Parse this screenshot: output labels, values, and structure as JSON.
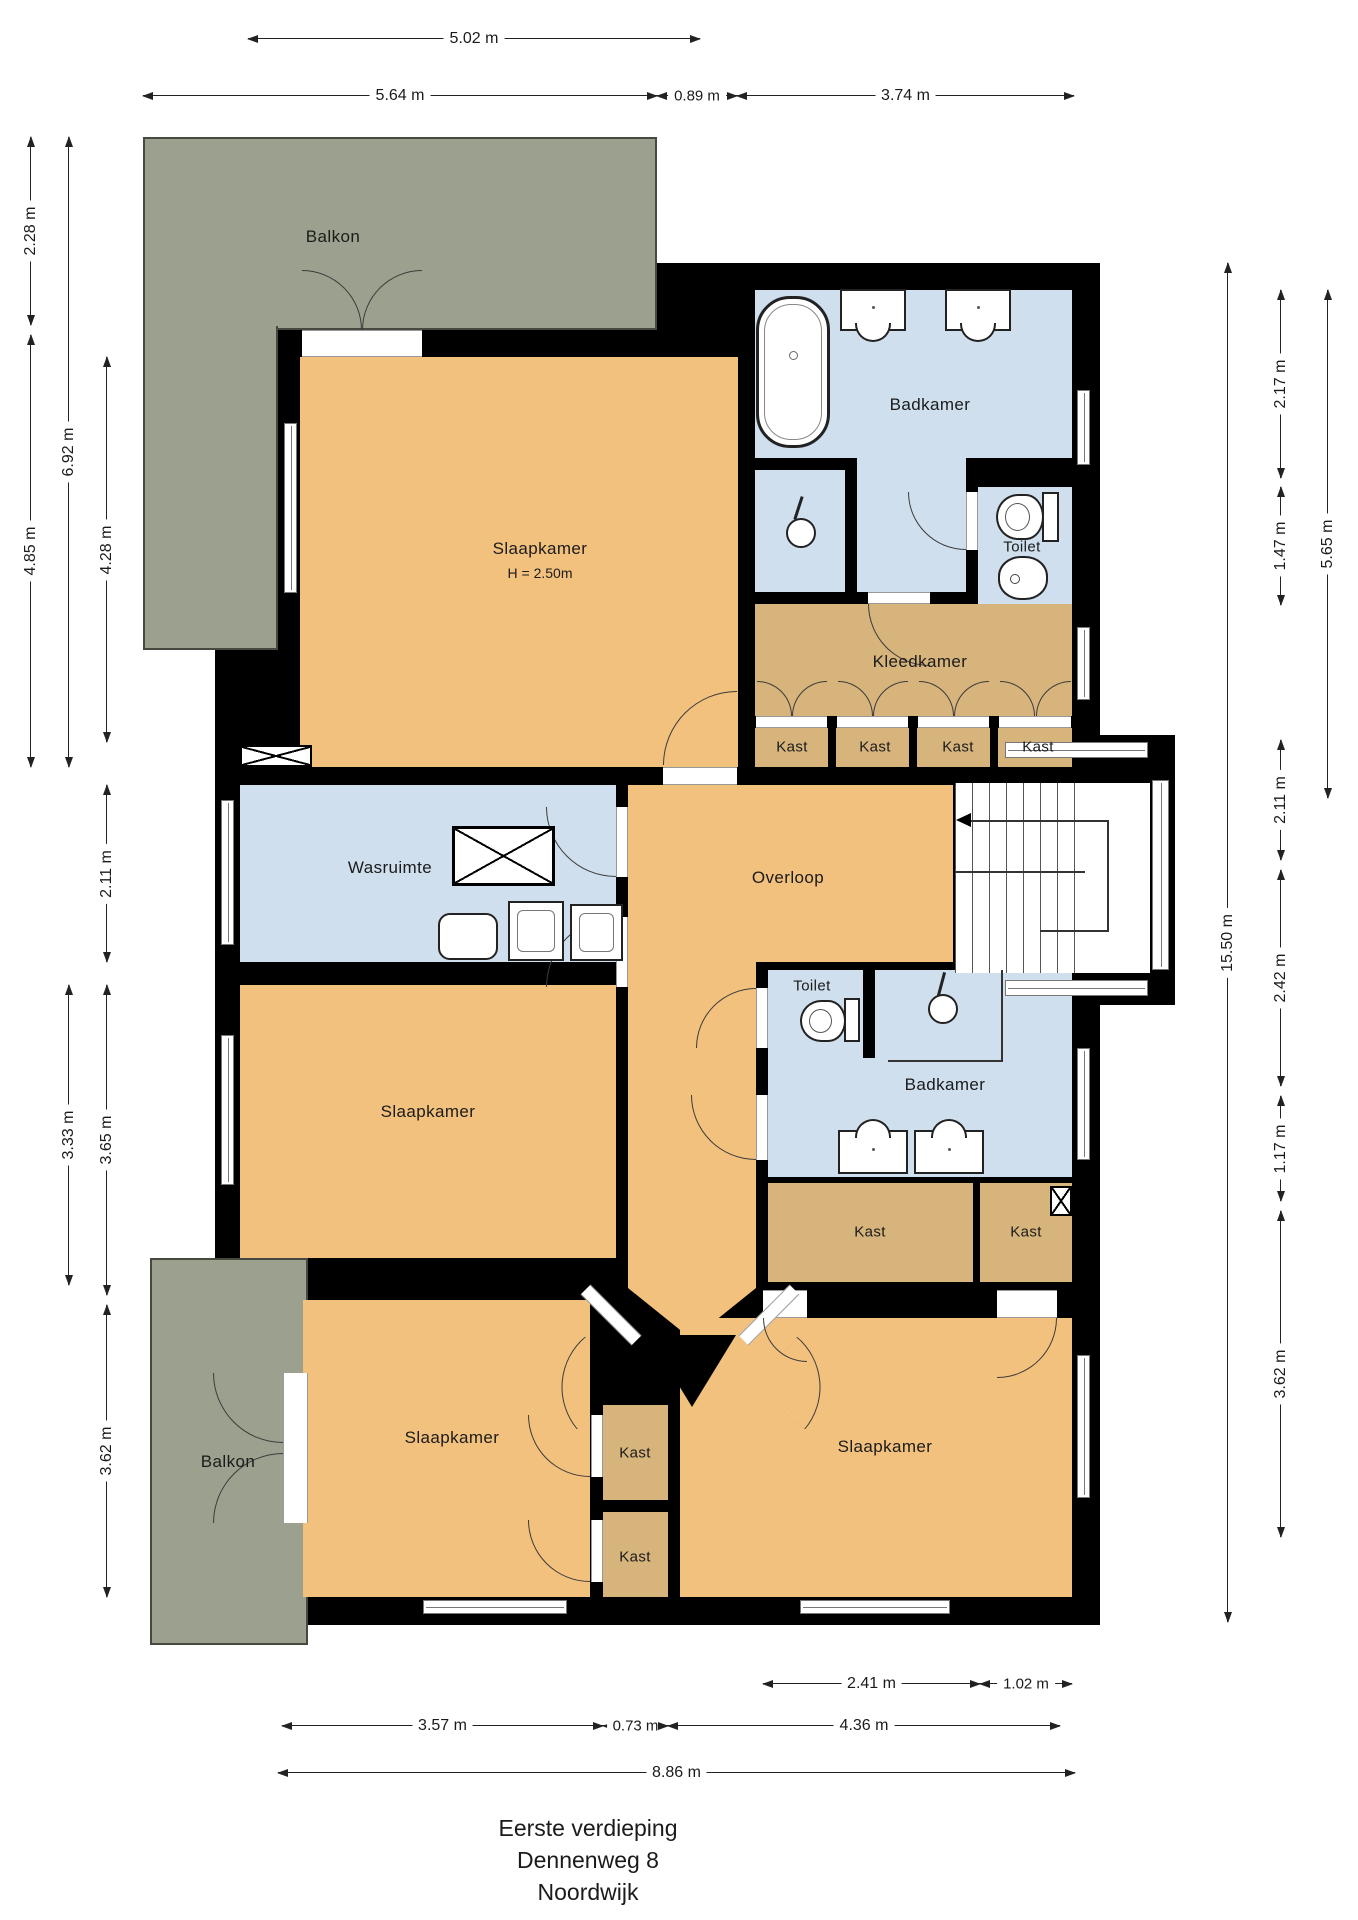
{
  "document": {
    "type": "floor-plan",
    "title_lines": [
      "Eerste verdieping",
      "Dennenweg 8",
      "Noordwijk"
    ]
  },
  "colors": {
    "wall": "#000000",
    "floor_room": "#f3c17e",
    "floor_wet": "#cfdfee",
    "floor_closet": "#d7b47b",
    "balcony": "#9ba18e",
    "dimension_line": "#222222"
  },
  "rooms": [
    {
      "id": "balkon-top",
      "label": "Balkon"
    },
    {
      "id": "slaapkamer-master",
      "label": "Slaapkamer",
      "sublabel": "H = 2.50m"
    },
    {
      "id": "badkamer-1",
      "label": "Badkamer"
    },
    {
      "id": "toilet-1",
      "label": "Toilet"
    },
    {
      "id": "kleedkamer",
      "label": "Kleedkamer"
    },
    {
      "id": "kast-1",
      "label": "Kast"
    },
    {
      "id": "kast-2",
      "label": "Kast"
    },
    {
      "id": "kast-3",
      "label": "Kast"
    },
    {
      "id": "kast-4",
      "label": "Kast"
    },
    {
      "id": "wasruimte",
      "label": "Wasruimte"
    },
    {
      "id": "overloop",
      "label": "Overloop"
    },
    {
      "id": "toilet-2",
      "label": "Toilet"
    },
    {
      "id": "badkamer-2",
      "label": "Badkamer"
    },
    {
      "id": "kast-5",
      "label": "Kast"
    },
    {
      "id": "kast-6",
      "label": "Kast"
    },
    {
      "id": "slaapkamer-mid",
      "label": "Slaapkamer"
    },
    {
      "id": "slaapkamer-bottomleft",
      "label": "Slaapkamer"
    },
    {
      "id": "kast-7",
      "label": "Kast"
    },
    {
      "id": "kast-8",
      "label": "Kast"
    },
    {
      "id": "slaapkamer-bottomright",
      "label": "Slaapkamer"
    },
    {
      "id": "balkon-bottom",
      "label": "Balkon"
    }
  ],
  "dimensions": {
    "top": [
      "5.02 m",
      "5.64 m",
      "0.89 m",
      "3.74 m"
    ],
    "left": [
      "2.28 m",
      "6.92 m",
      "4.85 m",
      "4.28 m",
      "2.11 m",
      "3.33 m",
      "3.65 m",
      "3.62 m"
    ],
    "right": [
      "2.17 m",
      "1.47 m",
      "5.65 m",
      "15.50 m",
      "2.11 m",
      "2.42 m",
      "1.17 m",
      "3.62 m"
    ],
    "bottom": [
      "2.41 m",
      "1.02 m",
      "3.57 m",
      "0.73 m",
      "4.36 m",
      "8.86 m"
    ]
  }
}
